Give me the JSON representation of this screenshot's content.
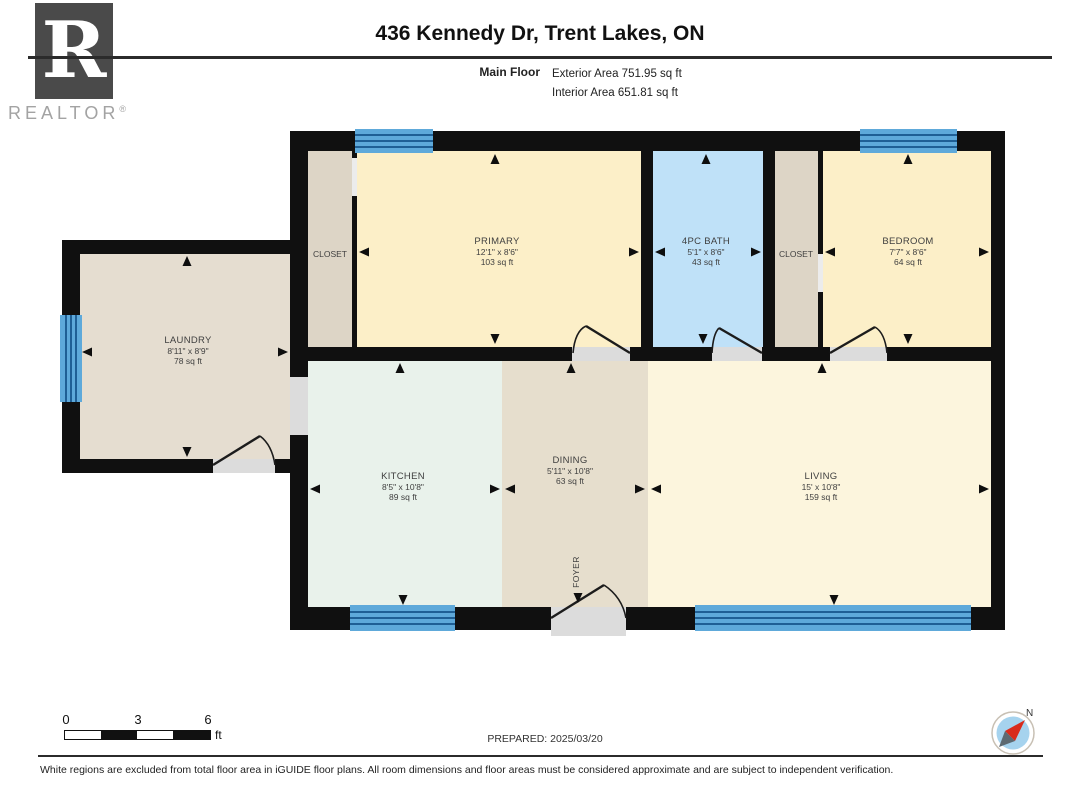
{
  "header": {
    "title": "436 Kennedy Dr, Trent Lakes, ON",
    "floor_label": "Main Floor",
    "exterior_area": "Exterior Area 751.95 sq ft",
    "interior_area": "Interior Area 651.81 sq ft"
  },
  "logo": {
    "letter": "R",
    "brand": "REALTOR",
    "registered": "®"
  },
  "rooms": {
    "laundry": {
      "name": "LAUNDRY",
      "dims": "8'11\" x 8'9\"",
      "area": "78 sq ft"
    },
    "closet_left": {
      "name": "CLOSET"
    },
    "primary": {
      "name": "PRIMARY",
      "dims": "12'1\" x 8'6\"",
      "area": "103 sq ft"
    },
    "bath": {
      "name": "4PC BATH",
      "dims": "5'1\" x 8'6\"",
      "area": "43 sq ft"
    },
    "closet_right": {
      "name": "CLOSET"
    },
    "bedroom": {
      "name": "BEDROOM",
      "dims": "7'7\" x 8'6\"",
      "area": "64 sq ft"
    },
    "kitchen": {
      "name": "KITCHEN",
      "dims": "8'5\" x 10'8\"",
      "area": "89 sq ft"
    },
    "dining": {
      "name": "DINING",
      "dims": "5'11\" x 10'8\"",
      "area": "63 sq ft"
    },
    "living": {
      "name": "LIVING",
      "dims": "15' x 10'8\"",
      "area": "159 sq ft"
    },
    "foyer": {
      "name": "FOYER"
    }
  },
  "scale_bar": {
    "tick_0": "0",
    "tick_mid": "3",
    "tick_end": "6",
    "unit": "ft"
  },
  "prepared": "PREPARED: 2025/03/20",
  "compass": {
    "label": "N"
  },
  "footer": "White regions are excluded from total floor area in iGUIDE floor plans. All room dimensions and floor areas must be considered approximate and are subject to independent verification.",
  "colors": {
    "wall": "#101010",
    "window": "#5ea9da",
    "window_line": "#1f5f95",
    "laundry_fill": "#e5ddd0",
    "closet_fill": "#ddd5c6",
    "bedroom_fill": "#fcefc8",
    "bath_fill": "#bfe1f8",
    "kitchen_fill": "#e9f2eb",
    "dining_fill": "#e6decd",
    "living_fill": "#fcf5dd",
    "threshold": "#dcdcdc",
    "compass_needle": "#d92b1c"
  }
}
